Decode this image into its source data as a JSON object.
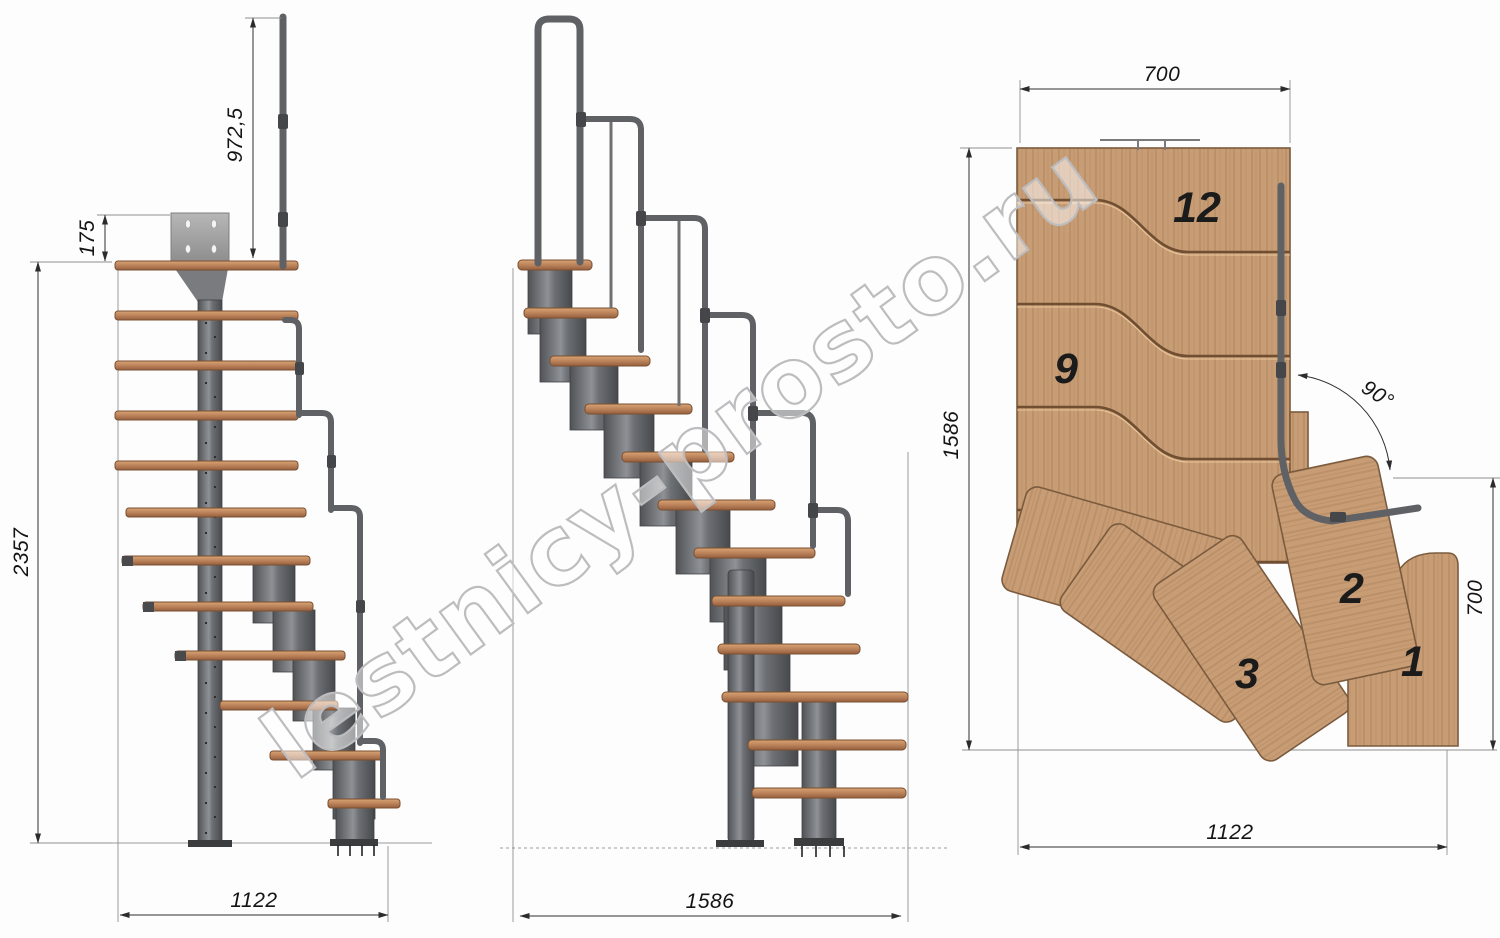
{
  "watermark": {
    "text": "lestnicy-prosto.ru"
  },
  "views": {
    "side_elevation": {
      "dims": {
        "handrail_height": "972,5",
        "top_plate_offset": "175",
        "total_height": "2357",
        "base_width": "1122"
      }
    },
    "front_elevation": {
      "dims": {
        "base_length": "1586"
      }
    },
    "plan": {
      "dims": {
        "top_width": "700",
        "left_length": "1586",
        "right_depth": "700",
        "bottom_width": "1122",
        "turn_angle": "90°"
      },
      "steps": [
        {
          "label": "12"
        },
        {
          "label": "9"
        },
        {
          "label": "3"
        },
        {
          "label": "2"
        },
        {
          "label": "1"
        }
      ]
    }
  },
  "colors": {
    "wood_side": "#b98058",
    "wood_plan": "#c89d76",
    "metal": "#5d5f63",
    "dimension_line": "#2e2e2e",
    "watermark_gray": "#bdbdbf",
    "background": "#fdfdfe"
  }
}
